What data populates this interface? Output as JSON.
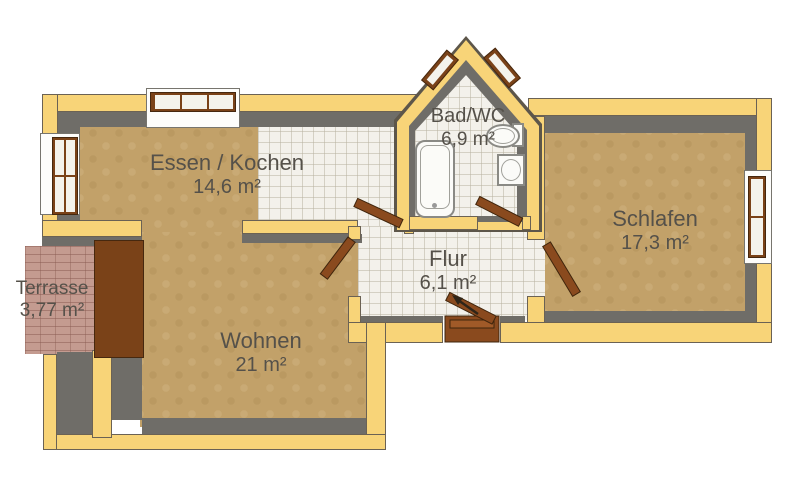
{
  "plan": {
    "rooms": [
      {
        "name": "Essen / Kochen",
        "area": "14,6 m²"
      },
      {
        "name": "Bad/WC",
        "area": "6,9 m²"
      },
      {
        "name": "Schlafen",
        "area": "17,3 m²"
      },
      {
        "name": "Flur",
        "area": "6,1 m²"
      },
      {
        "name": "Wohnen",
        "area": "21 m²"
      },
      {
        "name": "Terrasse",
        "area": "3,77 m²"
      }
    ],
    "fixtures": [
      "bathtub",
      "toilet",
      "washbasin"
    ],
    "doors": [
      "kitchen-hall-door",
      "living-hall-door",
      "bath-hall-door",
      "bedroom-hall-door",
      "entrance-door"
    ],
    "windows": [
      "kitchen-north-window",
      "kitchen-west-window",
      "bath-gable-window-left",
      "bath-gable-window-right",
      "bedroom-east-window",
      "terrace-door-window"
    ],
    "colors": {
      "wall": "#F8D478",
      "wall_inner": "#6F6D68",
      "floor_wood": "#C2A169",
      "floor_tile": "#F3F1EB",
      "terrace_brick": "#C49B90",
      "door_wood": "#8A4A1E",
      "label_text": "#55514A"
    }
  }
}
